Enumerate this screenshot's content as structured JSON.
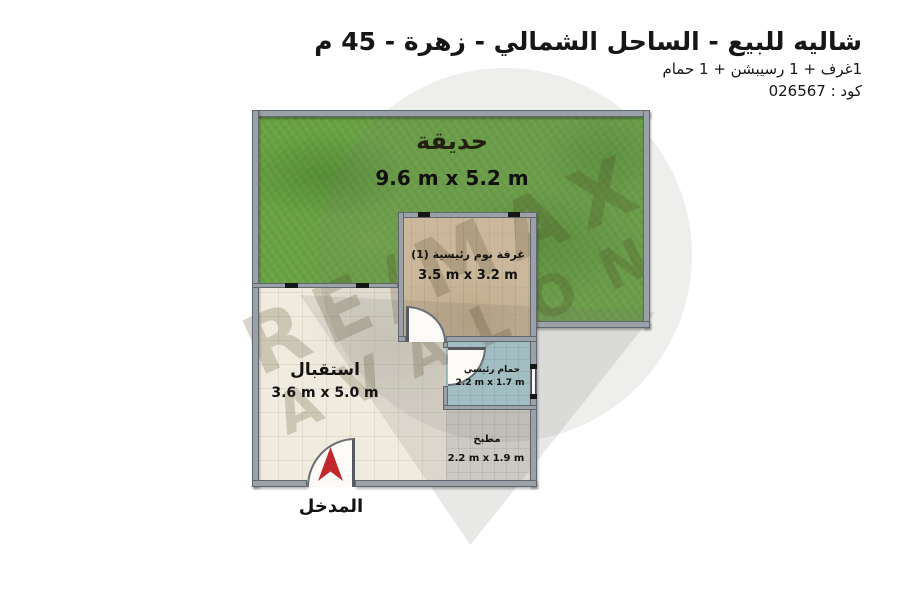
{
  "header": {
    "title": "شاليه للبيع - الساحل الشمالي - زهرة - 45 م",
    "subtitle": "1غرف + 1 رسيبشن + 1 حمام",
    "code": "كود : 026567"
  },
  "watermark": {
    "brand": "RE/MAX",
    "office": "AVALON"
  },
  "rooms": {
    "garden": {
      "label": "حديقة",
      "dimensions": "9.6 m x 5.2 m"
    },
    "bedroom": {
      "label": "غرفة نوم رئيسية (1)",
      "dimensions": "3.5 m x 3.2 m"
    },
    "reception": {
      "label": "استقبال",
      "dimensions": "3.6 m x 5.0 m"
    },
    "bathroom": {
      "label": "حمام رئيسي",
      "dimensions": "2.2 m x 1.7 m"
    },
    "kitchen": {
      "label": "مطبخ",
      "dimensions": "2.2 m x 1.9 m"
    },
    "entrance": {
      "label": "المدخل"
    }
  },
  "colors": {
    "garden_green": "#6aa245",
    "wood_floor": "#d7c2a2",
    "tile_floor": "#f0ebdf",
    "bathroom_blue": "#b5d9e2",
    "kitchen_gray": "#dcdad2",
    "wall_gray": "#9ba1a8",
    "entrance_arrow_red": "#c1272d",
    "watermark_gray": "#7a7a75"
  }
}
